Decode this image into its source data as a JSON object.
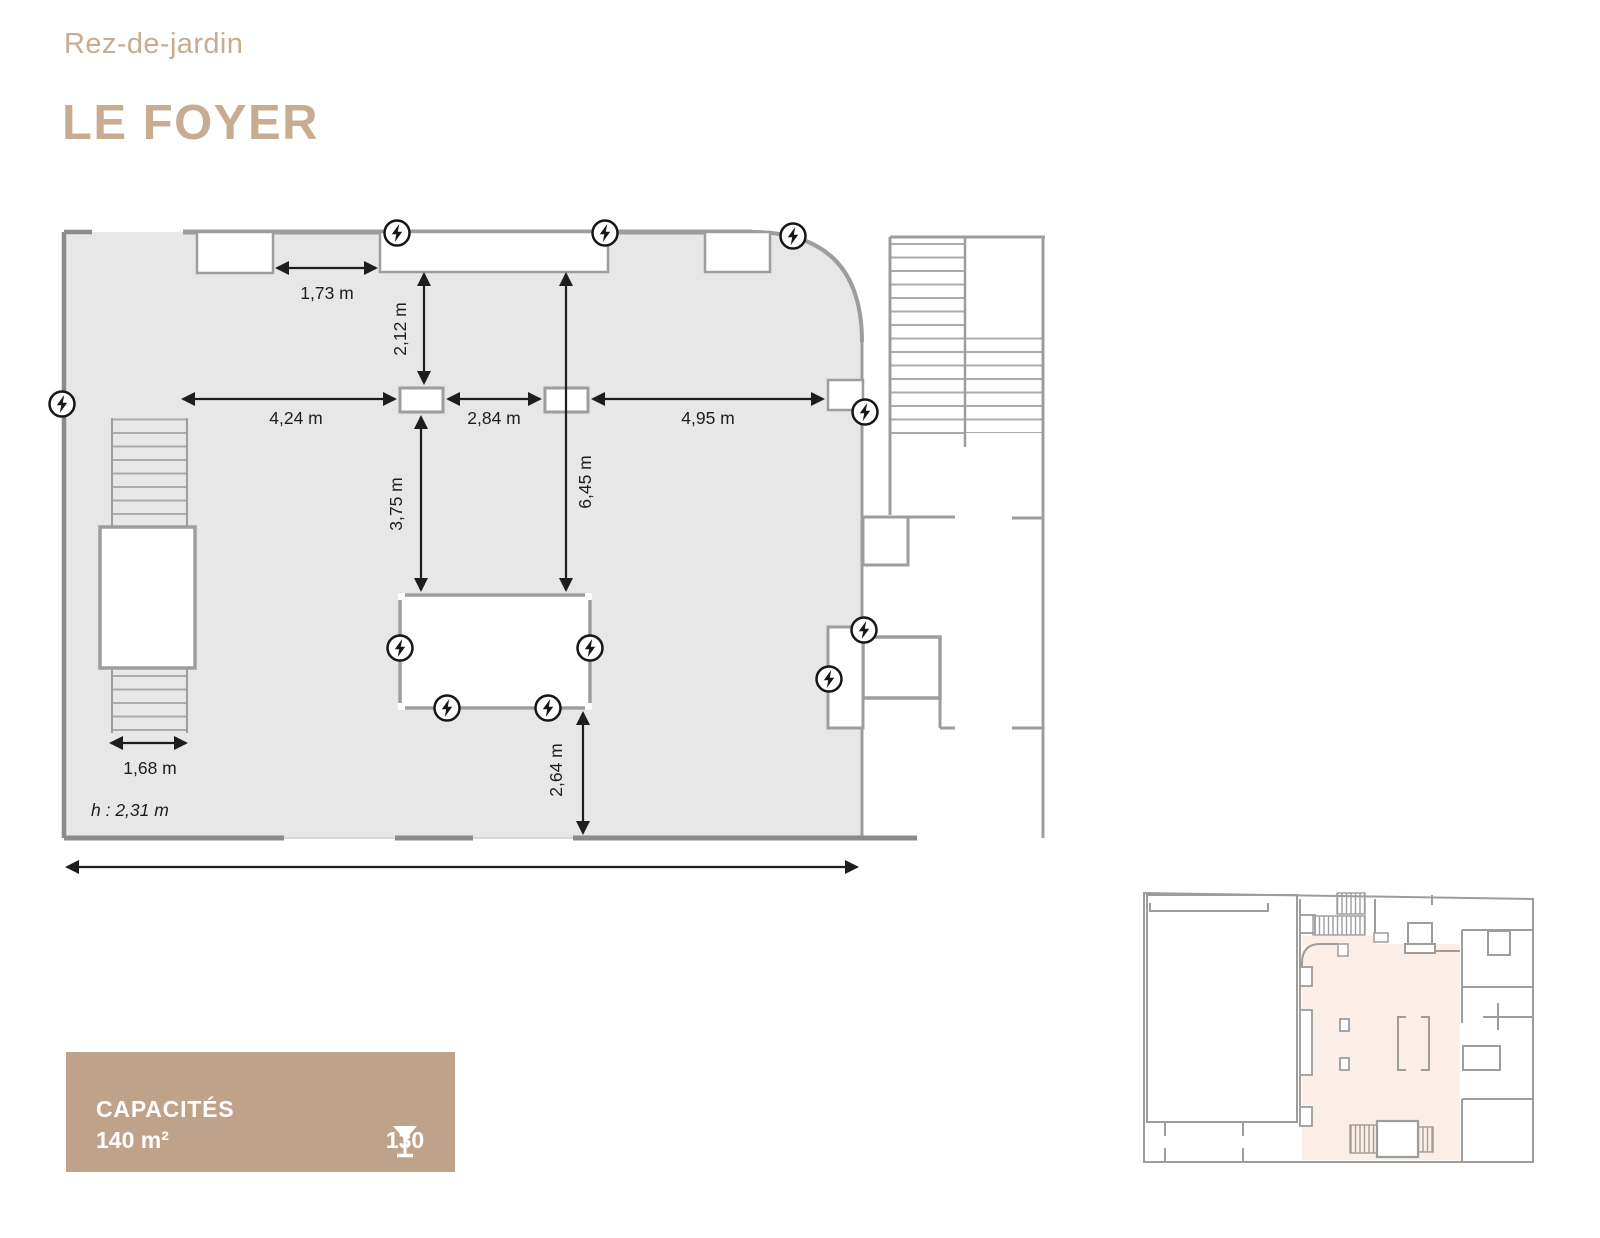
{
  "header": {
    "floor_label": "Rez-de-jardin",
    "title": "LE FOYER"
  },
  "plan": {
    "dims": {
      "d173": "1,73 m",
      "d212": "2,12 m",
      "d424": "4,24 m",
      "d284": "2,84 m",
      "d495": "4,95 m",
      "d375": "3,75 m",
      "d645": "6,45 m",
      "d264": "2,64 m",
      "d168": "1,68 m"
    },
    "ceiling_height": "h : 2,31 m",
    "outlet_icon": "power-outlet-lightning",
    "outlet_count": 11
  },
  "capacity_card": {
    "title": "CAPACITÉS",
    "area": "140 m²",
    "standing_icon": "martini-glass",
    "standing_capacity": "130"
  },
  "colors": {
    "accent_text": "#C8AC91",
    "card_bg": "#BFA28A",
    "room_fill": "#E7E7E7",
    "wall_gray": "#9D9D9C",
    "wall_dark": "#8B8B8A",
    "dim_black": "#1D1D1B",
    "minimap_highlight": "#FAEEE6"
  }
}
